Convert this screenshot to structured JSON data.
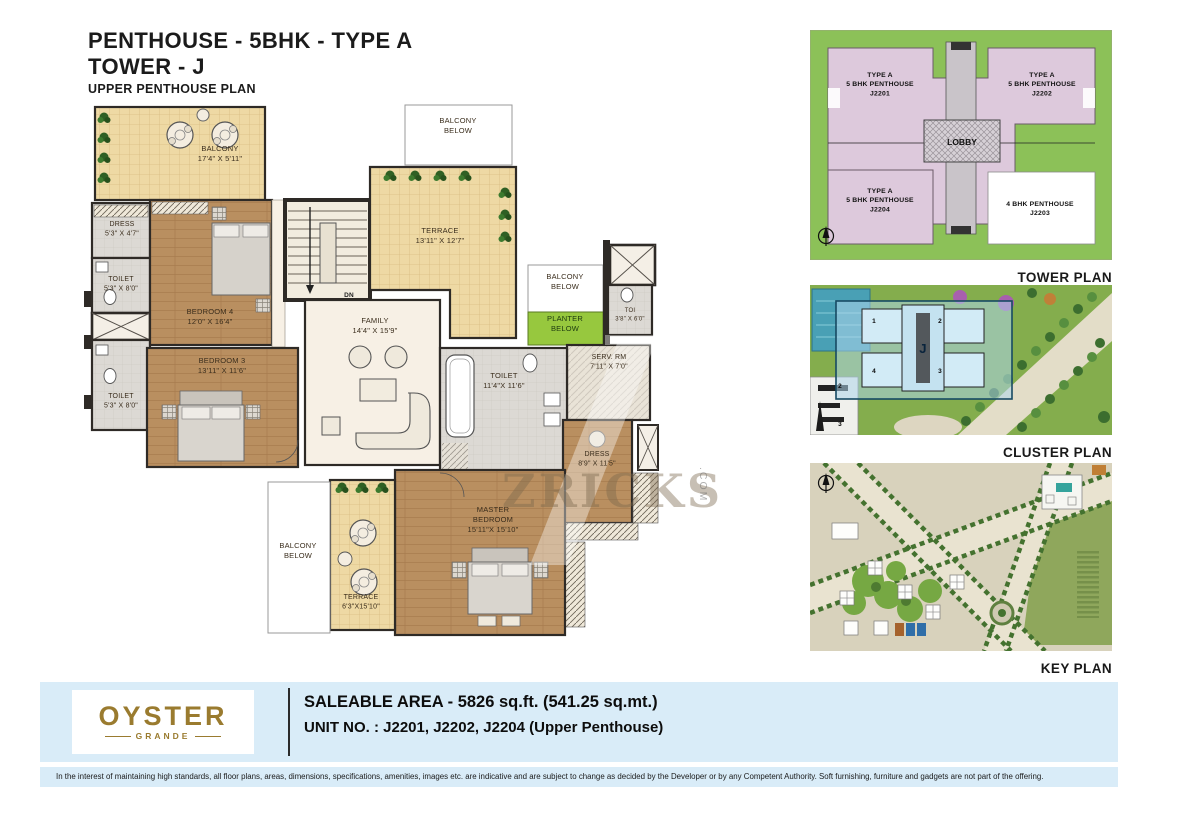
{
  "title": {
    "line1": "PENTHOUSE - 5BHK  - TYPE A",
    "line2": "TOWER - J",
    "line3": "UPPER PENTHOUSE PLAN"
  },
  "floorplan": {
    "watermark": {
      "text": "ZRICKS",
      "suffix": ".COM"
    },
    "labels": [
      {
        "id": "balcony-tl-label",
        "x": 160,
        "y": 56,
        "size": 7.5,
        "lines": [
          "BALCONY",
          "17'4\" X 5'11\""
        ]
      },
      {
        "id": "dress-tl-label",
        "x": 62,
        "y": 131,
        "size": 7,
        "lines": [
          "DRESS",
          "5'3\" X 4'7\""
        ]
      },
      {
        "id": "toilet-upper-label",
        "x": 61,
        "y": 186,
        "size": 7,
        "lines": [
          "TOILET",
          "5'3\" X 8'0\""
        ]
      },
      {
        "id": "toilet-lower-label",
        "x": 61,
        "y": 303,
        "size": 7,
        "lines": [
          "TOILET",
          "5'3\" X 8'0\""
        ]
      },
      {
        "id": "bedroom4-label",
        "x": 150,
        "y": 219,
        "size": 7.5,
        "lines": [
          "BEDROOM 4",
          "12'0\" X 16'4\""
        ]
      },
      {
        "id": "bedroom3-label",
        "x": 162,
        "y": 268,
        "size": 7.5,
        "lines": [
          "BEDROOM 3",
          "13'11\" X 11'6\""
        ]
      },
      {
        "id": "family-label",
        "x": 315,
        "y": 228,
        "size": 7.5,
        "lines": [
          "FAMILY",
          "14'4\" X 15'9\""
        ]
      },
      {
        "id": "terrace-top-label",
        "x": 380,
        "y": 138,
        "size": 7.5,
        "lines": [
          "TERRACE",
          "13'11\" X 12'7\""
        ]
      },
      {
        "id": "balcony-below-top-label",
        "x": 398,
        "y": 28,
        "size": 7.5,
        "lines": [
          "BALCONY",
          "BELOW"
        ]
      },
      {
        "id": "balcony-below-right-label",
        "x": 505,
        "y": 184,
        "size": 7.5,
        "lines": [
          "BALCONY",
          "BELOW"
        ]
      },
      {
        "id": "planter-below-label",
        "x": 505,
        "y": 226,
        "size": 7.5,
        "fill": "#1d3a10",
        "lines": [
          "PLANTER",
          "BELOW"
        ]
      },
      {
        "id": "toi-small-label",
        "x": 570,
        "y": 217,
        "size": 6,
        "lines": [
          "TOI",
          "3'8\" X 6'0\""
        ]
      },
      {
        "id": "serv-rm-label",
        "x": 549,
        "y": 264,
        "size": 7,
        "lines": [
          "SERV. RM",
          "7'11\" X 7'0\""
        ]
      },
      {
        "id": "toilet-big-label",
        "x": 444,
        "y": 283,
        "size": 7.5,
        "lines": [
          "TOILET",
          "11'4\"X 11'6\""
        ]
      },
      {
        "id": "dress2-label",
        "x": 537,
        "y": 361,
        "size": 7,
        "lines": [
          "DRESS",
          "8'9\" X 11'5\""
        ]
      },
      {
        "id": "master-bedroom-label",
        "x": 433,
        "y": 417,
        "size": 7.5,
        "lines": [
          "MASTER",
          "BEDROOM",
          "15'11\"X 15'10\""
        ]
      },
      {
        "id": "terrace-bottom-label",
        "x": 301,
        "y": 504,
        "size": 7,
        "lines": [
          "TERRACE",
          "6'3\"X15'10\""
        ]
      },
      {
        "id": "balcony-below-bl-label",
        "x": 238,
        "y": 453,
        "size": 7.5,
        "lines": [
          "BALCONY",
          "BELOW"
        ]
      },
      {
        "id": "dn-label",
        "x": 289,
        "y": 202,
        "size": 6.5,
        "bold": true,
        "fill": "#222222",
        "lines": [
          "DN"
        ]
      }
    ]
  },
  "tower_plan": {
    "caption": "TOWER PLAN",
    "lobby": "LOBBY",
    "units": [
      {
        "id": "unit-j2201-label",
        "x": 70,
        "y": 47,
        "size": 6.8,
        "bold": true,
        "fill": "#111111",
        "lines": [
          "TYPE A",
          "5 BHK PENTHOUSE",
          "J2201"
        ]
      },
      {
        "id": "unit-j2202-label",
        "x": 232,
        "y": 47,
        "size": 6.8,
        "bold": true,
        "fill": "#111111",
        "lines": [
          "TYPE A",
          "5 BHK PENTHOUSE",
          "J2202"
        ]
      },
      {
        "id": "unit-j2204-label",
        "x": 70,
        "y": 163,
        "size": 6.8,
        "bold": true,
        "fill": "#111111",
        "lines": [
          "TYPE A",
          "5 BHK PENTHOUSE",
          "J2204"
        ]
      },
      {
        "id": "unit-j2203-label",
        "x": 230,
        "y": 176,
        "size": 6.8,
        "bold": true,
        "fill": "#111111",
        "lines": [
          "4 BHK PENTHOUSE",
          "J2203"
        ]
      }
    ]
  },
  "cluster_plan": {
    "caption": "CLUSTER PLAN",
    "labels": [
      {
        "id": "cluster-tower-j-label",
        "x": 113,
        "y": 68,
        "size": 13,
        "bold": true,
        "fill": "#09233c",
        "lines": [
          "J"
        ]
      },
      {
        "id": "cluster-wing-1-label",
        "x": 64,
        "y": 38,
        "size": 6.5,
        "bold": true,
        "fill": "#0a0a0a",
        "lines": [
          "1"
        ]
      },
      {
        "id": "cluster-wing-2-label",
        "x": 130,
        "y": 38,
        "size": 6.5,
        "bold": true,
        "fill": "#0a0a0a",
        "lines": [
          "2"
        ]
      },
      {
        "id": "cluster-wing-4-label",
        "x": 64,
        "y": 88,
        "size": 6.5,
        "bold": true,
        "fill": "#0a0a0a",
        "lines": [
          "4"
        ]
      },
      {
        "id": "cluster-wing-3-label",
        "x": 130,
        "y": 88,
        "size": 6.5,
        "bold": true,
        "fill": "#0a0a0a",
        "lines": [
          "3"
        ]
      },
      {
        "id": "cluster-bldg-2-label",
        "x": 30,
        "y": 103,
        "size": 6.5,
        "bold": true,
        "fill": "#0a0a0a",
        "lines": [
          "2"
        ]
      },
      {
        "id": "cluster-bldg-3-label",
        "x": 30,
        "y": 141,
        "size": 6.5,
        "bold": true,
        "fill": "#0a0a0a",
        "lines": [
          "3"
        ]
      }
    ]
  },
  "key_plan": {
    "caption": "KEY PLAN"
  },
  "footer": {
    "brand": "OYSTER",
    "brand_sub": "GRANDE",
    "saleable_area": "SALEABLE AREA - 5826 sq.ft. (541.25 sq.mt.)",
    "unit_no": "UNIT NO. :  J2201, J2202, J2204 (Upper Penthouse)"
  },
  "disclaimer": "In the interest of maintaining high standards, all floor plans, areas, dimensions, specifications, amenities, images etc. are indicative and are subject to change as decided by the Developer or by any Competent Authority. Soft furnishing, furniture and gadgets are not part of the offering."
}
